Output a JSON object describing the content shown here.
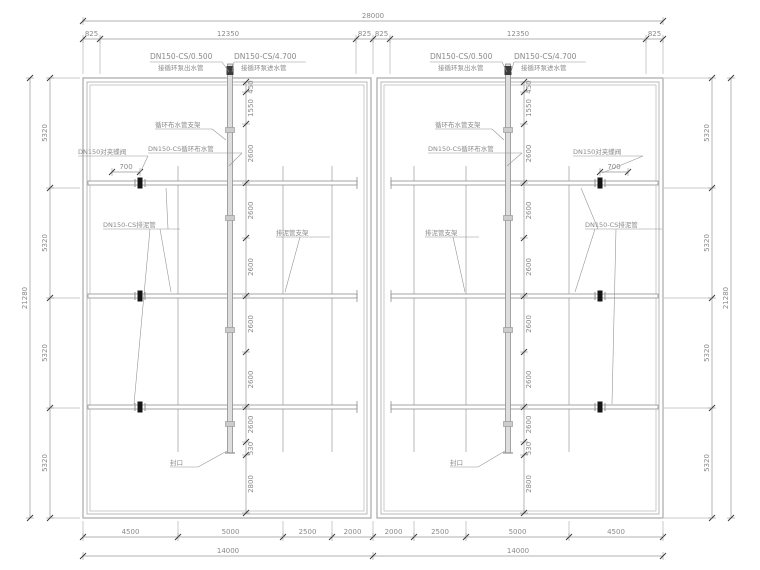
{
  "colors": {
    "background": "#ffffff",
    "line": "#9b9b9b",
    "wall": "#a8a8a8",
    "pipe_fill": "#dedede",
    "pipe_edge": "#8f8f8f",
    "dim": "#969696",
    "tick": "#3a3a3a",
    "text": "#8a8a8a",
    "valve": "#151515",
    "fitting": "#3c3c3c"
  },
  "canvas": {
    "width": 760,
    "height": 570
  },
  "structure": {
    "basins": [
      {
        "name": "basin-left",
        "outer": [
          83,
          78,
          288,
          440
        ]
      },
      {
        "name": "basin-right",
        "outer": [
          377,
          78,
          286,
          440
        ]
      }
    ],
    "rows_y": [
      183,
      296,
      407
    ],
    "sides": [
      {
        "name": "left",
        "pipe_x": 230,
        "row_x1": 88,
        "row_x2": 357,
        "free_end": 357,
        "laterals": [
          178,
          283,
          332
        ],
        "valve_x": 140
      },
      {
        "name": "right",
        "pipe_x": 508,
        "row_x1": 391,
        "row_x2": 658,
        "free_end": 391,
        "laterals": [
          414,
          466,
          569
        ],
        "valve_x": 600
      }
    ],
    "pipe_top_y": 64,
    "pipe_bot_y": 453,
    "lateral_top_y": 166,
    "lateral_bot_y": 452,
    "supports_y": [
      130,
      218,
      330,
      424
    ]
  },
  "dims": {
    "top_total": {
      "axis": "h",
      "y": 21,
      "ticks": [
        83,
        663
      ],
      "labels": [
        "28000"
      ],
      "ext": 0
    },
    "top_chain": {
      "axis": "h",
      "y": 39,
      "ticks": [
        83,
        100,
        356,
        373,
        390,
        646,
        663
      ],
      "labels": [
        "825",
        "12350",
        "825",
        "825",
        "12350",
        "825"
      ],
      "ext": 74
    },
    "bottom_chain": {
      "axis": "h",
      "y": 537,
      "ticks": [
        83,
        178,
        283,
        332,
        373,
        414,
        466,
        569,
        663
      ],
      "labels": [
        "4500",
        "5000",
        "2500",
        "2000",
        "2000",
        "2500",
        "5000",
        "4500"
      ],
      "ext": 521
    },
    "bottom_total": {
      "axis": "h",
      "y": 556,
      "ticks": [
        83,
        373,
        663
      ],
      "labels": [
        "14000",
        "14000"
      ],
      "ext": 0
    },
    "left_outer": {
      "axis": "v",
      "x": 30,
      "ticks": [
        78,
        518
      ],
      "labels": [
        "21280"
      ],
      "ext": 0
    },
    "left_chain": {
      "axis": "v",
      "x": 50,
      "ticks": [
        78,
        188,
        298,
        408,
        518
      ],
      "labels": [
        "5320",
        "5320",
        "5320",
        "5320"
      ],
      "ext": 80
    },
    "right_chain": {
      "axis": "v",
      "x": 712,
      "ticks": [
        78,
        188,
        298,
        408,
        518
      ],
      "labels": [
        "5320",
        "5320",
        "5320",
        "5320"
      ],
      "ext": 664
    },
    "right_outer": {
      "axis": "v",
      "x": 731,
      "ticks": [
        78,
        518
      ],
      "labels": [
        "21280"
      ],
      "ext": 0
    },
    "mid_left": {
      "axis": "v",
      "x": 246,
      "ticks": [
        82,
        92,
        124,
        183,
        238,
        296,
        352,
        407,
        442,
        455,
        513
      ],
      "labels": [
        "450",
        "1550",
        "2600",
        "2600",
        "2600",
        "2600",
        "2600",
        "2600",
        "530",
        "2800"
      ],
      "ext": 0,
      "near": true
    },
    "mid_right": {
      "axis": "v",
      "x": 524,
      "ticks": [
        82,
        92,
        124,
        183,
        238,
        296,
        352,
        407,
        442,
        455,
        513
      ],
      "labels": [
        "450",
        "1550",
        "2600",
        "2600",
        "2600",
        "2600",
        "2600",
        "2600",
        "530",
        "2800"
      ],
      "ext": 0,
      "near": true
    },
    "valve_left": {
      "axis": "h",
      "y": 172,
      "ticks": [
        112,
        140
      ],
      "labels": [
        "700"
      ],
      "ext": 0
    },
    "valve_right": {
      "axis": "h",
      "y": 172,
      "ticks": [
        600,
        628
      ],
      "labels": [
        "700"
      ],
      "ext": 0
    }
  },
  "labels": [
    {
      "name": "pipe-tag-outlet-left",
      "text": "DN150-CS/0.500",
      "x": 150,
      "y": 59,
      "size": 7.5,
      "leaders": [
        [
          [
            150,
            62
          ],
          [
            222,
            62
          ]
        ],
        [
          [
            222,
            62
          ],
          [
            229,
            72
          ]
        ]
      ]
    },
    {
      "name": "note-outlet-left",
      "text": "接循环泵出水管",
      "x": 158,
      "y": 70,
      "size": 6.5,
      "leaders": []
    },
    {
      "name": "pipe-tag-inlet-left",
      "text": "DN150-CS/4.700",
      "x": 234,
      "y": 59,
      "size": 7.5,
      "leaders": [
        [
          [
            234,
            62
          ],
          [
            306,
            62
          ]
        ],
        [
          [
            234,
            62
          ],
          [
            232,
            72
          ]
        ]
      ]
    },
    {
      "name": "note-inlet-left",
      "text": "接循环泵进水管",
      "x": 241,
      "y": 70,
      "size": 6.5,
      "leaders": []
    },
    {
      "name": "circ-support-left",
      "text": "循环布水管支架",
      "x": 155,
      "y": 127,
      "size": 6.5,
      "leaders": [
        [
          [
            155,
            129
          ],
          [
            212,
            129
          ]
        ],
        [
          [
            212,
            129
          ],
          [
            226,
            140
          ]
        ]
      ]
    },
    {
      "name": "circ-pipe-left",
      "text": "DN150-CS循环布水管",
      "x": 148,
      "y": 151,
      "size": 6.5,
      "leaders": [
        [
          [
            148,
            153
          ],
          [
            242,
            153
          ]
        ],
        [
          [
            242,
            153
          ],
          [
            229,
            166
          ]
        ]
      ]
    },
    {
      "name": "valve-label-left",
      "text": "DN150对夹蝶阀",
      "x": 78,
      "y": 154,
      "size": 6.5,
      "leaders": [
        [
          [
            78,
            156
          ],
          [
            148,
            156
          ]
        ],
        [
          [
            148,
            156
          ],
          [
            140,
            173
          ]
        ]
      ]
    },
    {
      "name": "sludge-pipe-left",
      "text": "DN150-CS排泥管",
      "x": 103,
      "y": 227,
      "size": 6.5,
      "leaders": [
        [
          [
            103,
            229
          ],
          [
            180,
            229
          ]
        ],
        [
          [
            168,
            229
          ],
          [
            166,
            188
          ]
        ],
        [
          [
            160,
            229
          ],
          [
            171,
            292
          ]
        ],
        [
          [
            150,
            229
          ],
          [
            134,
            404
          ]
        ]
      ]
    },
    {
      "name": "sludge-support-left",
      "text": "排泥管支架",
      "x": 276,
      "y": 235,
      "size": 6.5,
      "leaders": [
        [
          [
            276,
            237
          ],
          [
            330,
            237
          ]
        ],
        [
          [
            300,
            237
          ],
          [
            285,
            292
          ]
        ]
      ]
    },
    {
      "name": "cap-label-left",
      "text": "封口",
      "x": 170,
      "y": 465,
      "size": 6.5,
      "leaders": [
        [
          [
            170,
            467
          ],
          [
            198,
            467
          ]
        ],
        [
          [
            198,
            467
          ],
          [
            227,
            451
          ]
        ]
      ]
    },
    {
      "name": "pipe-tag-outlet-right",
      "text": "DN150-CS/0.500",
      "x": 430,
      "y": 59,
      "size": 7.5,
      "leaders": [
        [
          [
            430,
            62
          ],
          [
            502,
            62
          ]
        ],
        [
          [
            502,
            62
          ],
          [
            507,
            72
          ]
        ]
      ]
    },
    {
      "name": "note-outlet-right",
      "text": "接循环泵出水管",
      "x": 438,
      "y": 70,
      "size": 6.5,
      "leaders": []
    },
    {
      "name": "pipe-tag-inlet-right",
      "text": "DN150-CS/4.700",
      "x": 514,
      "y": 59,
      "size": 7.5,
      "leaders": [
        [
          [
            514,
            62
          ],
          [
            586,
            62
          ]
        ],
        [
          [
            514,
            62
          ],
          [
            511,
            72
          ]
        ]
      ]
    },
    {
      "name": "note-inlet-right",
      "text": "接循环泵进水管",
      "x": 521,
      "y": 70,
      "size": 6.5,
      "leaders": []
    },
    {
      "name": "circ-support-right",
      "text": "循环布水管支架",
      "x": 435,
      "y": 127,
      "size": 6.5,
      "leaders": [
        [
          [
            435,
            129
          ],
          [
            492,
            129
          ]
        ],
        [
          [
            492,
            129
          ],
          [
            504,
            140
          ]
        ]
      ]
    },
    {
      "name": "circ-pipe-right",
      "text": "DN150-CS循环布水管",
      "x": 428,
      "y": 151,
      "size": 6.5,
      "leaders": [
        [
          [
            428,
            153
          ],
          [
            522,
            153
          ]
        ],
        [
          [
            522,
            153
          ],
          [
            507,
            166
          ]
        ]
      ]
    },
    {
      "name": "valve-label-right",
      "text": "DN150对夹蝶阀",
      "x": 573,
      "y": 154,
      "size": 6.5,
      "leaders": [
        [
          [
            573,
            156
          ],
          [
            643,
            156
          ]
        ],
        [
          [
            643,
            156
          ],
          [
            602,
            173
          ]
        ]
      ]
    },
    {
      "name": "sludge-pipe-right",
      "text": "DN150-CS排泥管",
      "x": 585,
      "y": 227,
      "size": 6.5,
      "leaders": [
        [
          [
            585,
            229
          ],
          [
            662,
            229
          ]
        ],
        [
          [
            598,
            229
          ],
          [
            581,
            188
          ]
        ],
        [
          [
            595,
            229
          ],
          [
            575,
            292
          ]
        ],
        [
          [
            616,
            229
          ],
          [
            612,
            404
          ]
        ]
      ]
    },
    {
      "name": "sludge-support-right",
      "text": "排泥管支架",
      "x": 425,
      "y": 235,
      "size": 6.5,
      "leaders": [
        [
          [
            425,
            237
          ],
          [
            479,
            237
          ]
        ],
        [
          [
            453,
            237
          ],
          [
            465,
            292
          ]
        ]
      ]
    },
    {
      "name": "cap-label-right",
      "text": "封口",
      "x": 450,
      "y": 465,
      "size": 6.5,
      "leaders": [
        [
          [
            450,
            467
          ],
          [
            478,
            467
          ]
        ],
        [
          [
            478,
            467
          ],
          [
            505,
            451
          ]
        ]
      ]
    }
  ]
}
